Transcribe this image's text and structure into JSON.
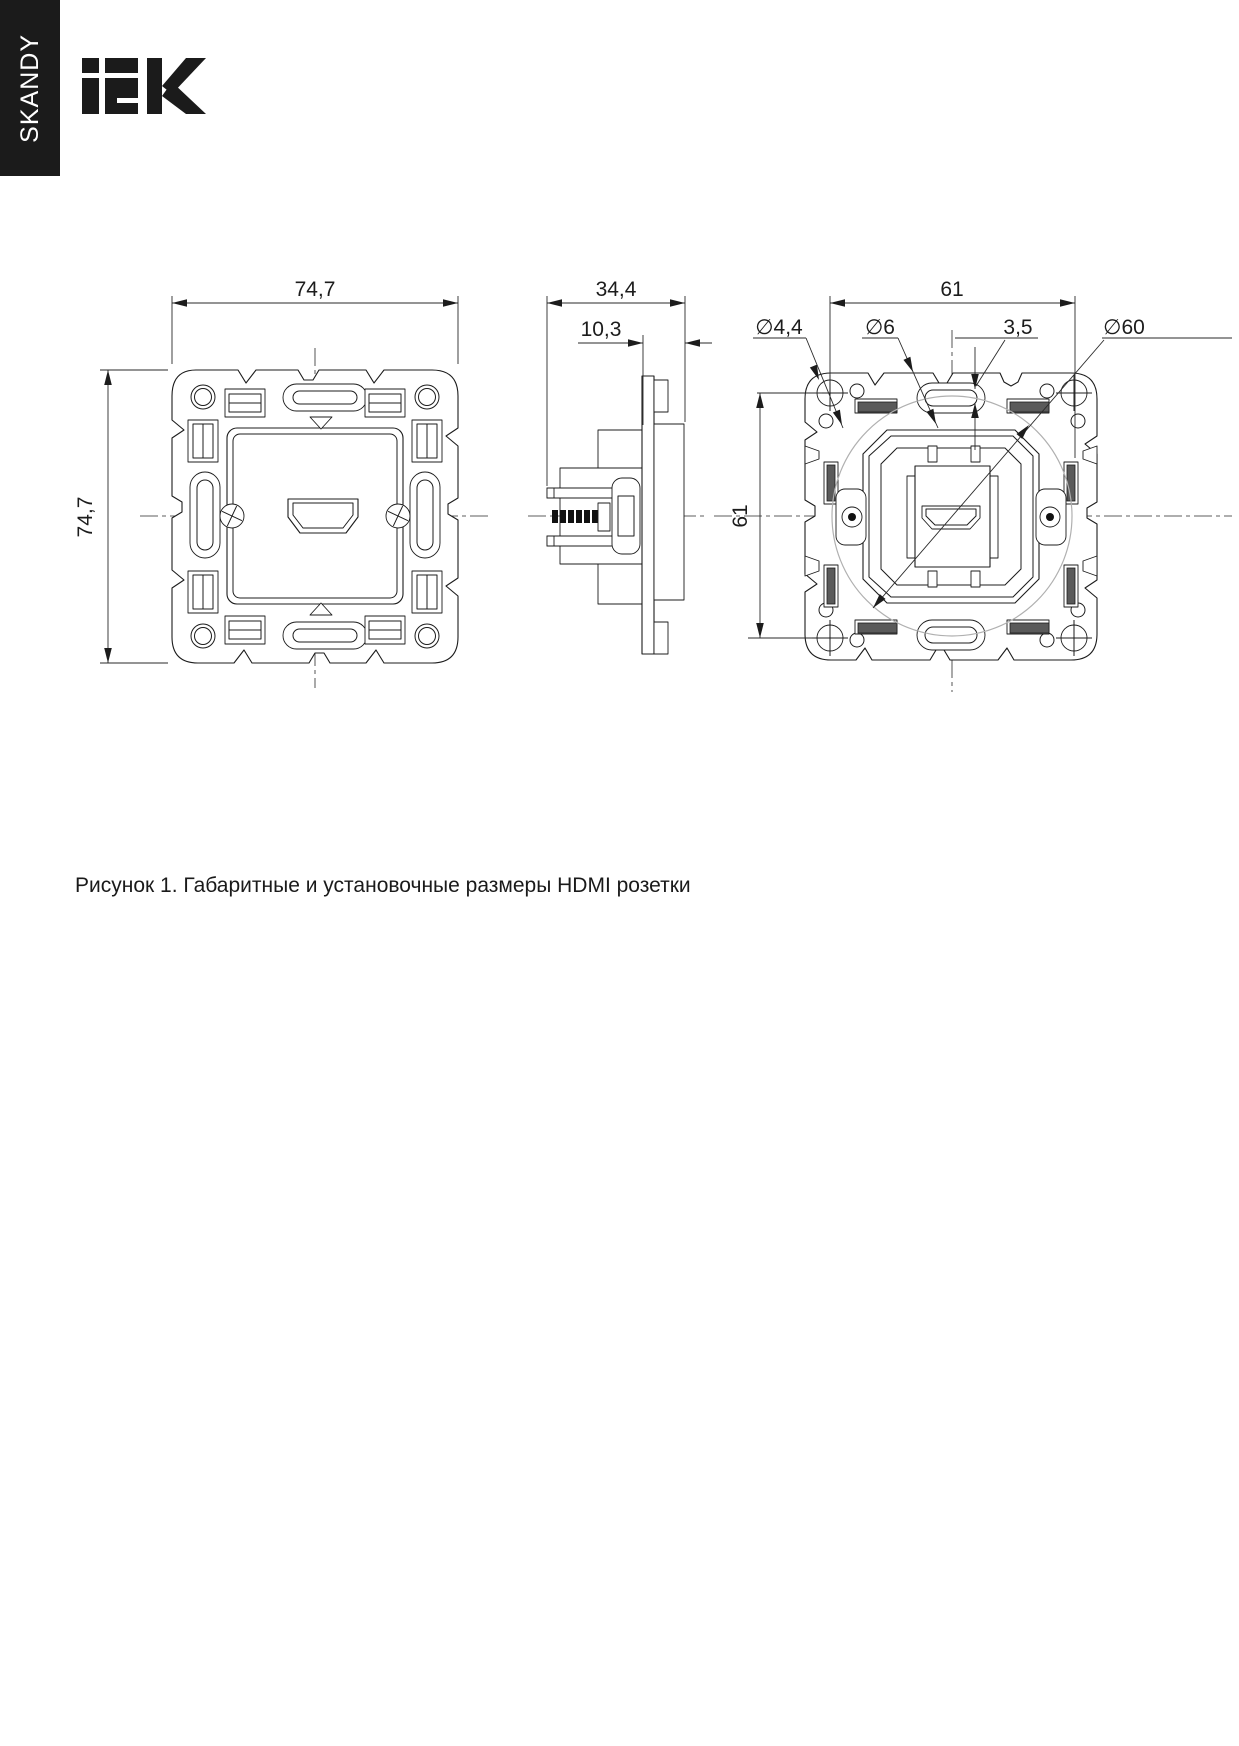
{
  "banner": {
    "label": "SKANDY",
    "bg": "#1b1b1b",
    "fg": "#ffffff"
  },
  "logo": {
    "brand": "IEK",
    "color": "#1b1b1b"
  },
  "figure": {
    "caption": "Рисунок 1. Габаритные и установочные размеры HDMI розетки",
    "line_color": "#1c1c1c",
    "guide_color": "#b0b0b0",
    "views": {
      "front": {
        "width": "74,7",
        "height": "74,7"
      },
      "side": {
        "depth": "34,4",
        "panel_offset": "10,3"
      },
      "back": {
        "mount_width": "61",
        "mount_height": "61",
        "screw_hole_d": "∅4,4",
        "hole_d": "∅6",
        "claw_gap": "3,5",
        "box_d": "∅60"
      }
    }
  }
}
